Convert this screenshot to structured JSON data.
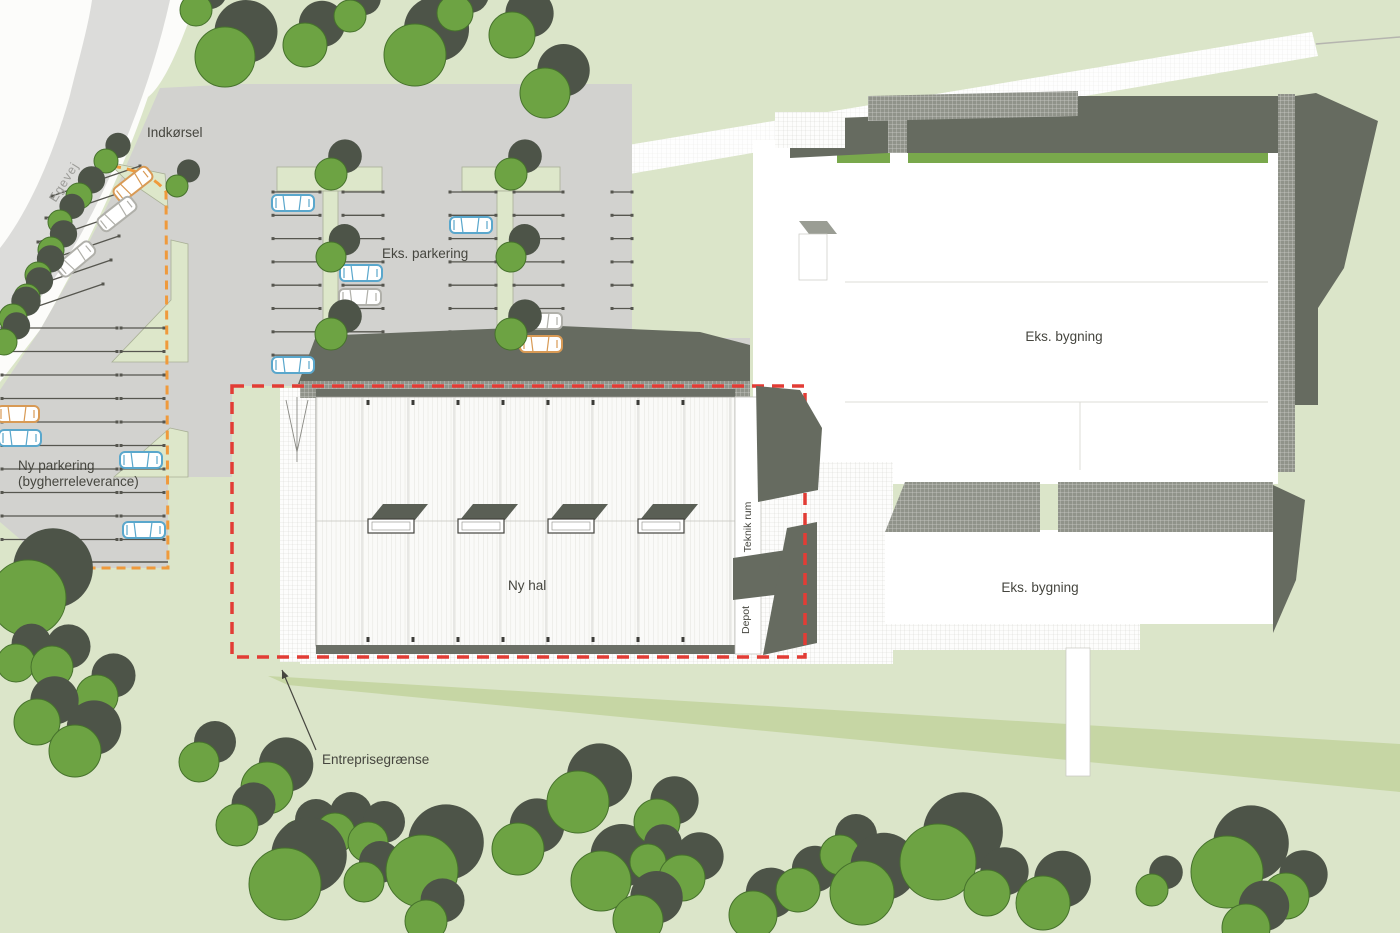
{
  "labels": {
    "road": "Egevej",
    "entrance": "Indkørsel",
    "existing_parking": "Eks. parkering",
    "new_parking_line1": "Ny parkering",
    "new_parking_line2": "(bygherreleverance)",
    "new_hall": "Ny hal",
    "tech_room": "Teknik rum",
    "depot": "Depot",
    "site_boundary": "Entreprisegrænse",
    "existing_building_north": "Eks. bygning",
    "existing_building_south": "Eks. bygning"
  },
  "colors": {
    "bg": "#dbe5c9",
    "grass_band": "#c6d6a4",
    "road_white": "#fcfcfa",
    "road_gray": "#dcdcda",
    "pavement": "#d2d2cf",
    "island": "#dde7ca",
    "shadow": "#666b60",
    "skylight_shadow": "#5a5f55",
    "tree_green": "#6da343",
    "tree_dark": "#4d5448",
    "tree_stroke": "#46722c",
    "hatch_dark": "#90938a",
    "hall_bg": "#fafaf8",
    "bldg_green": "#79a84c",
    "red": "#e23c35",
    "orange": "#ef9a3c",
    "text": "#46463f",
    "road_label": "#9c9c98",
    "car_blue": "#5aa7cc",
    "car_gray": "#b0b0aa",
    "car_orange": "#d89a55",
    "bay_line": "#56564f"
  },
  "site": {
    "trees": [
      [
        196,
        10,
        16
      ],
      [
        225,
        57,
        30
      ],
      [
        305,
        45,
        22
      ],
      [
        350,
        16,
        16
      ],
      [
        415,
        55,
        31
      ],
      [
        455,
        13,
        18
      ],
      [
        512,
        35,
        23
      ],
      [
        545,
        93,
        25
      ],
      [
        106,
        161,
        12
      ],
      [
        79,
        196,
        13
      ],
      [
        60,
        222,
        12
      ],
      [
        51,
        250,
        13
      ],
      [
        38,
        275,
        13
      ],
      [
        27,
        297,
        13
      ],
      [
        13,
        318,
        14
      ],
      [
        4,
        342,
        13
      ],
      [
        177,
        186,
        11
      ],
      [
        331,
        174,
        16
      ],
      [
        331,
        257,
        15
      ],
      [
        331,
        334,
        16
      ],
      [
        511,
        174,
        16
      ],
      [
        511,
        257,
        15
      ],
      [
        511,
        334,
        16
      ],
      [
        28,
        598,
        38
      ],
      [
        16,
        663,
        19
      ],
      [
        52,
        667,
        21
      ],
      [
        97,
        696,
        21
      ],
      [
        37,
        722,
        23
      ],
      [
        75,
        751,
        26
      ],
      [
        199,
        762,
        20
      ],
      [
        267,
        788,
        26
      ],
      [
        237,
        825,
        21
      ],
      [
        300,
        840,
        20
      ],
      [
        335,
        833,
        20
      ],
      [
        368,
        842,
        20
      ],
      [
        285,
        884,
        36
      ],
      [
        364,
        882,
        20
      ],
      [
        422,
        871,
        36
      ],
      [
        426,
        921,
        21
      ],
      [
        518,
        849,
        26
      ],
      [
        578,
        802,
        31
      ],
      [
        601,
        881,
        30
      ],
      [
        657,
        822,
        23
      ],
      [
        648,
        862,
        18
      ],
      [
        682,
        878,
        23
      ],
      [
        638,
        920,
        25
      ],
      [
        753,
        915,
        24
      ],
      [
        798,
        890,
        22
      ],
      [
        840,
        855,
        20
      ],
      [
        862,
        893,
        32
      ],
      [
        938,
        862,
        38
      ],
      [
        987,
        893,
        23
      ],
      [
        1043,
        903,
        27
      ],
      [
        1152,
        890,
        16
      ],
      [
        1227,
        872,
        36
      ],
      [
        1286,
        896,
        23
      ],
      [
        1246,
        928,
        24
      ]
    ],
    "cars": [
      {
        "x": 18,
        "y": 414,
        "rot": 0,
        "c": "car_orange"
      },
      {
        "x": 20,
        "y": 438,
        "rot": 0,
        "c": "car_blue"
      },
      {
        "x": 141,
        "y": 460,
        "rot": 0,
        "c": "car_blue"
      },
      {
        "x": 144,
        "y": 530,
        "rot": 0,
        "c": "car_blue"
      },
      {
        "x": 133,
        "y": 184,
        "rot": -38,
        "c": "car_orange"
      },
      {
        "x": 117,
        "y": 214,
        "rot": -38,
        "c": "car_gray"
      },
      {
        "x": 76,
        "y": 259,
        "rot": -40,
        "c": "car_gray"
      },
      {
        "x": 293,
        "y": 203,
        "rot": 0,
        "c": "car_blue"
      },
      {
        "x": 471,
        "y": 225,
        "rot": 0,
        "c": "car_blue"
      },
      {
        "x": 361,
        "y": 273,
        "rot": 0,
        "c": "car_blue"
      },
      {
        "x": 360,
        "y": 297,
        "rot": 0,
        "c": "car_gray"
      },
      {
        "x": 541,
        "y": 321,
        "rot": 0,
        "c": "car_gray"
      },
      {
        "x": 541,
        "y": 344,
        "rot": 0,
        "c": "car_orange"
      },
      {
        "x": 293,
        "y": 365,
        "rot": 0,
        "c": "car_blue"
      }
    ],
    "eks_parking_rows": {
      "y0": 192,
      "step": 23.3,
      "count": 8,
      "groups": [
        [
          273,
          320
        ],
        [
          343,
          383
        ],
        [
          450,
          496
        ],
        [
          514,
          563
        ],
        [
          612,
          632
        ]
      ]
    },
    "ny_parking_rows": {
      "y0": 328,
      "step": 23.5,
      "count": 10,
      "groups": [
        [
          2,
          117
        ],
        [
          121,
          164
        ]
      ]
    },
    "ny_parking_diagonal_rows": [
      [
        52,
        196,
        140,
        166
      ],
      [
        46,
        218,
        134,
        188
      ],
      [
        38,
        242,
        126,
        212
      ],
      [
        31,
        266,
        119,
        236
      ],
      [
        23,
        290,
        111,
        260
      ],
      [
        15,
        314,
        103,
        284
      ]
    ],
    "hall": {
      "panel_x0": 362,
      "panel_step": 46,
      "panel_x1": 735,
      "top": 397,
      "bottom": 645,
      "ridge_y": 521,
      "tick_xs": [
        368,
        413,
        458,
        503,
        548,
        593,
        638,
        683
      ],
      "skylight_xs": [
        368,
        458,
        548,
        638
      ],
      "skylight_y": 519
    }
  }
}
